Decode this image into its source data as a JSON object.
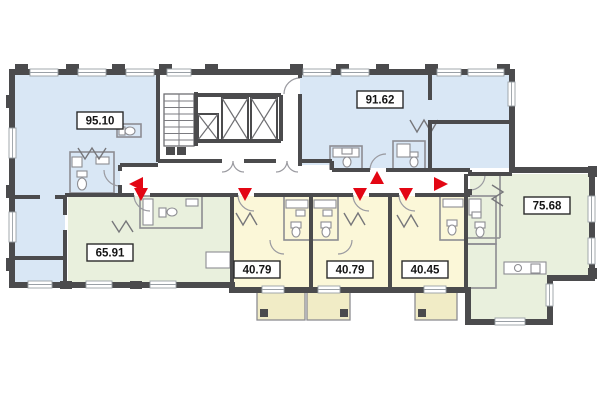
{
  "plan": {
    "units": [
      {
        "name": "apartment-95-10",
        "area": "95.10",
        "fill": "#d9e7f5"
      },
      {
        "name": "apartment-91-62",
        "area": "91.62",
        "fill": "#d9e7f5"
      },
      {
        "name": "apartment-65-91",
        "area": "65.91",
        "fill": "#e9f0dd"
      },
      {
        "name": "apartment-40-79-left",
        "area": "40.79",
        "fill": "#fbf7d8"
      },
      {
        "name": "apartment-40-79-right",
        "area": "40.79",
        "fill": "#fbf7d8"
      },
      {
        "name": "apartment-40-45",
        "area": "40.45",
        "fill": "#fbf7d8"
      },
      {
        "name": "apartment-75-68",
        "area": "75.68",
        "fill": "#e9f0dd"
      }
    ],
    "balcony_fill": "#f1ecc6",
    "arrow_color": "#e30613",
    "wall_color": "#4b4b4d",
    "core": {
      "staircase": "staircase",
      "elevator_count": 3
    },
    "entrances": [
      {
        "unit": "95.10",
        "direction": "left"
      },
      {
        "unit": "65.91",
        "direction": "down"
      },
      {
        "unit": "40.79 left",
        "direction": "down"
      },
      {
        "unit": "40.79 right",
        "direction": "down"
      },
      {
        "unit": "91.62",
        "direction": "up"
      },
      {
        "unit": "40.45",
        "direction": "down"
      },
      {
        "unit": "75.68",
        "direction": "right"
      }
    ]
  }
}
